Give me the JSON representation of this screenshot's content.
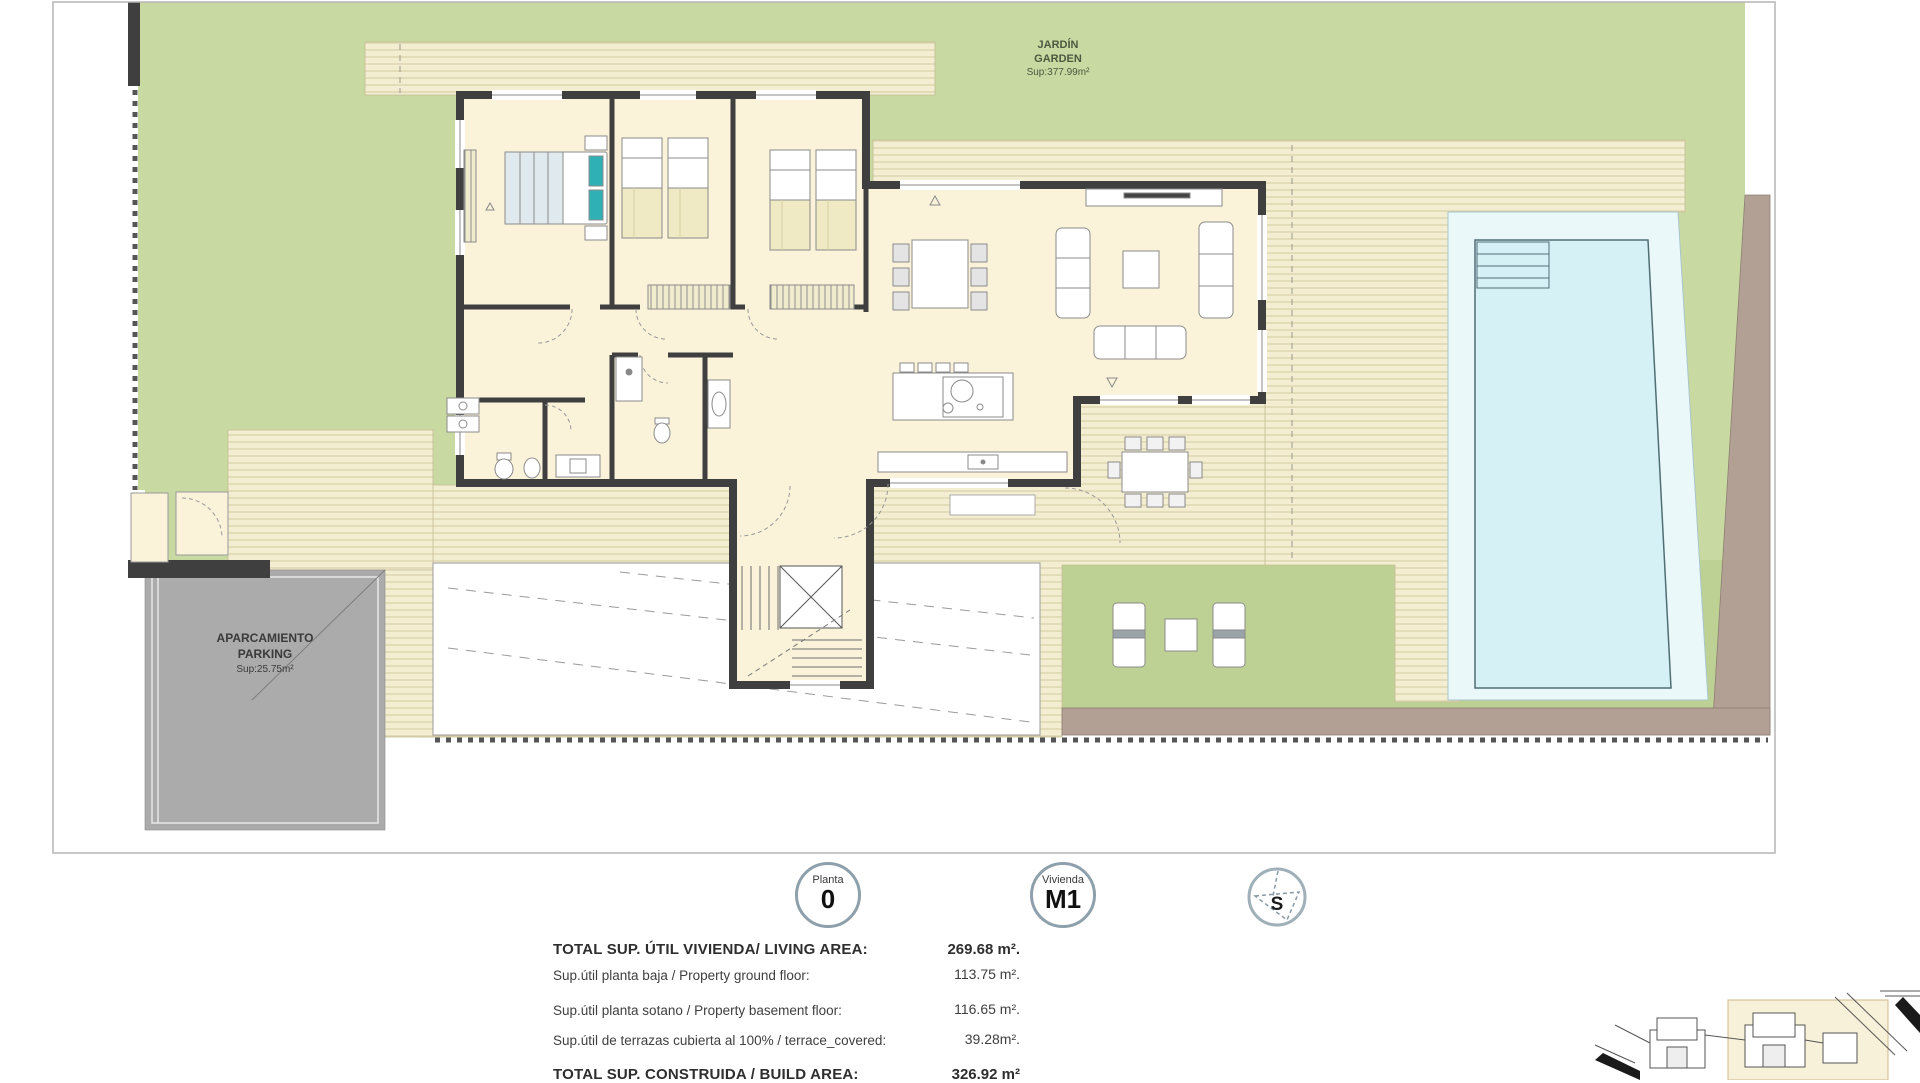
{
  "plan_labels": {
    "garden": {
      "line1": "JARDÍN",
      "line2": "GARDEN",
      "sup": "Sup:377.99m²"
    },
    "parking": {
      "line1": "APARCAMIENTO",
      "line2": "PARKING",
      "sup": "Sup:25.75m²"
    }
  },
  "badges": {
    "planta": {
      "label": "Planta",
      "value": "0"
    },
    "vivienda": {
      "label": "Vivienda",
      "value": "M1"
    },
    "compass": {
      "label": "S"
    }
  },
  "summary_rows": [
    {
      "label": "TOTAL SUP. ÚTIL  VIVIENDA/ LIVING AREA:",
      "value": "269.68 m²."
    },
    {
      "label": "Sup.útil planta baja / Property ground floor:",
      "value": "113.75 m²."
    },
    {
      "label": "Sup.útil planta sotano / Property basement floor:",
      "value": "116.65 m²."
    },
    {
      "label": "Sup.útil de terrazas cubierta al 100% / terrace_covered:",
      "value": "39.28m²."
    },
    {
      "label": "TOTAL SUP. CONSTRUIDA / BUILD AREA:",
      "value": "326.92 m²"
    }
  ],
  "colors": {
    "garden_green": "#c8d9a1",
    "garden_green_dark": "#bcd193",
    "deck_cream": "#f3edd2",
    "deck_stripe": "#d9d0a6",
    "house_floor": "#faf3da",
    "wall_dark": "#3f3f3f",
    "parking_gray": "#ababab",
    "pool_water": "#d6f1f6",
    "pool_pad": "#ebf8fa",
    "earth_brown": "#b3a094",
    "pillow_teal": "#2fb0b4"
  },
  "icon_names": [
    "compass-icon",
    "north-triangle-marker"
  ]
}
